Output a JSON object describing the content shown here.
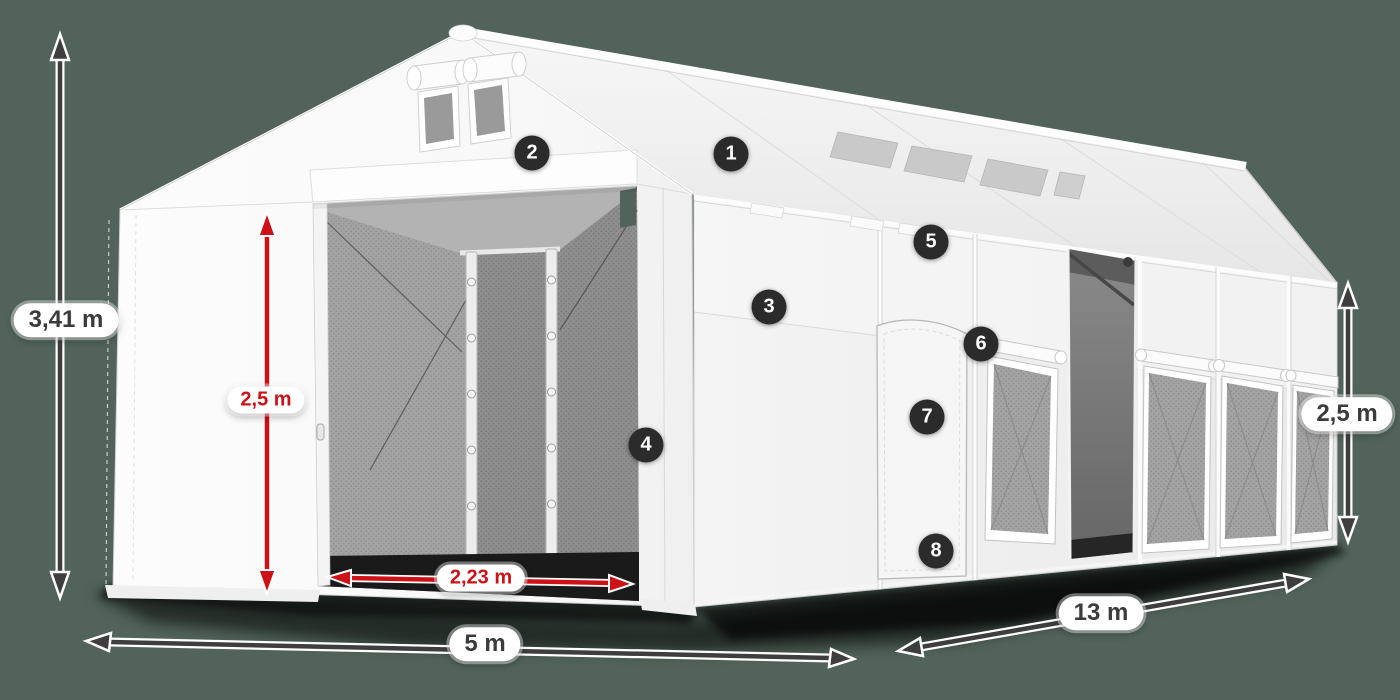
{
  "scene": {
    "background_color": "#51635A",
    "subject": "white storage tent illustration with dimension arrows"
  },
  "dimension_labels": {
    "total_height": "3,41 m",
    "entrance_height": "2,5 m",
    "entrance_width": "2,23 m",
    "tent_width": "5 m",
    "tent_length": "13 m",
    "side_wall_height": "2,5 m"
  },
  "feature_markers": [
    {
      "number": "1"
    },
    {
      "number": "2"
    },
    {
      "number": "3"
    },
    {
      "number": "4"
    },
    {
      "number": "5"
    },
    {
      "number": "6"
    },
    {
      "number": "7"
    },
    {
      "number": "8"
    }
  ],
  "colors": {
    "background": "#51635A",
    "dimension_red": "#CE1117",
    "dimension_dark": "#3E3E3E",
    "marker_background": "#2B2B2B",
    "marker_text": "#FFFFFF",
    "label_background": "#FFFFFF",
    "label_text_dark": "#3B3B3B",
    "tent_fabric": "#F7F7F7",
    "mesh_gray": "#A3A3A3",
    "interior_gray": "#6F6F6F"
  }
}
